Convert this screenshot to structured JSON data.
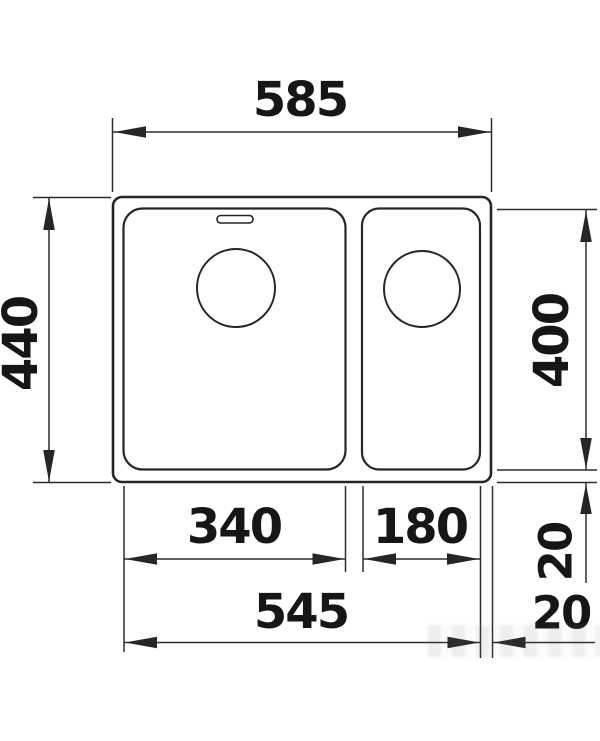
{
  "drawing": {
    "type": "kitchen-sink-dimension-diagram",
    "line_color": "#262626",
    "background": "#ffffff",
    "labels": {
      "overall_width": "585",
      "overall_depth": "440",
      "bowl_inner_depth": "400",
      "main_bowl_width": "340",
      "half_bowl_width": "180",
      "bowls_outer_width": "545",
      "bottom_edge_gap": "20",
      "right_edge_gap": "20"
    }
  }
}
